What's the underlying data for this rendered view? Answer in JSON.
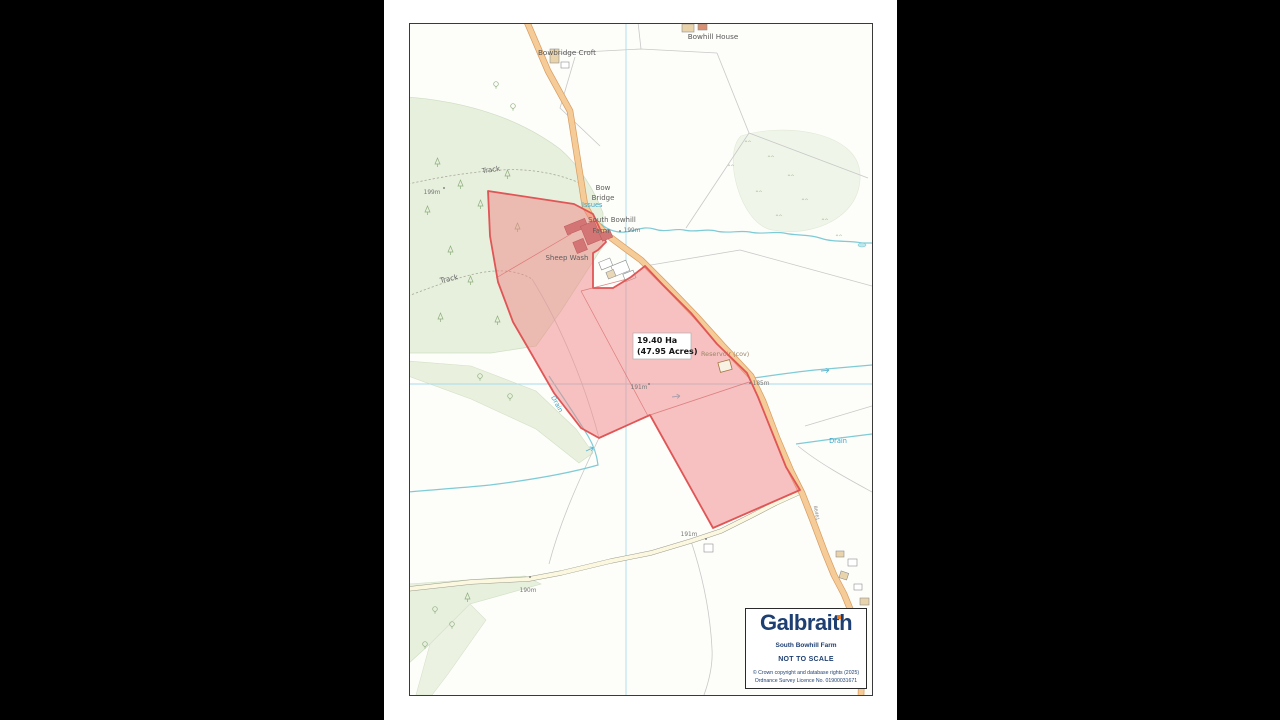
{
  "map": {
    "place_labels": {
      "bowbridge_croft": "Bowbridge Croft",
      "bowhill_house": "Bowhill House",
      "bow_bridge_line1": "Bow",
      "bow_bridge_line2": "Bridge",
      "farm_line1": "South Bowhill",
      "farm_line2": "Farm",
      "sheep_wash": "Sheep Wash",
      "issues": "Issues",
      "reservoir": "Reservoir (cov)",
      "track_north": "Track",
      "track_south": "Track",
      "drain_west": "Drain",
      "drain_east": "Drain",
      "road_number": "B6461"
    },
    "spot_heights": {
      "farm": "199m",
      "wood": "199m",
      "field": "191m",
      "road_east": "185m",
      "road_south": "191m",
      "road_west": "190m"
    },
    "area_label": {
      "line1": "19.40 Ha",
      "line2": "(47.95 Acres)"
    }
  },
  "legend": {
    "brand": "Galbraith",
    "property_name": "South Bowhill Farm",
    "scale_note": "NOT TO SCALE",
    "copyright_line1": "© Crown copyright and database rights (2025)",
    "copyright_line2": "Ordnance Survey Licence No. 01900031671"
  },
  "colors": {
    "parcel_fill": "#ef8585",
    "parcel_outline": "#e05555",
    "road_fill": "#f5cb97",
    "minor_road_fill": "#fcf8e0",
    "water": "#7ecbd6",
    "grid": "#a8dcec",
    "woodland": "#e7efdd",
    "brand_navy": "#1e3f72",
    "brand_orange": "#ea7c26"
  }
}
